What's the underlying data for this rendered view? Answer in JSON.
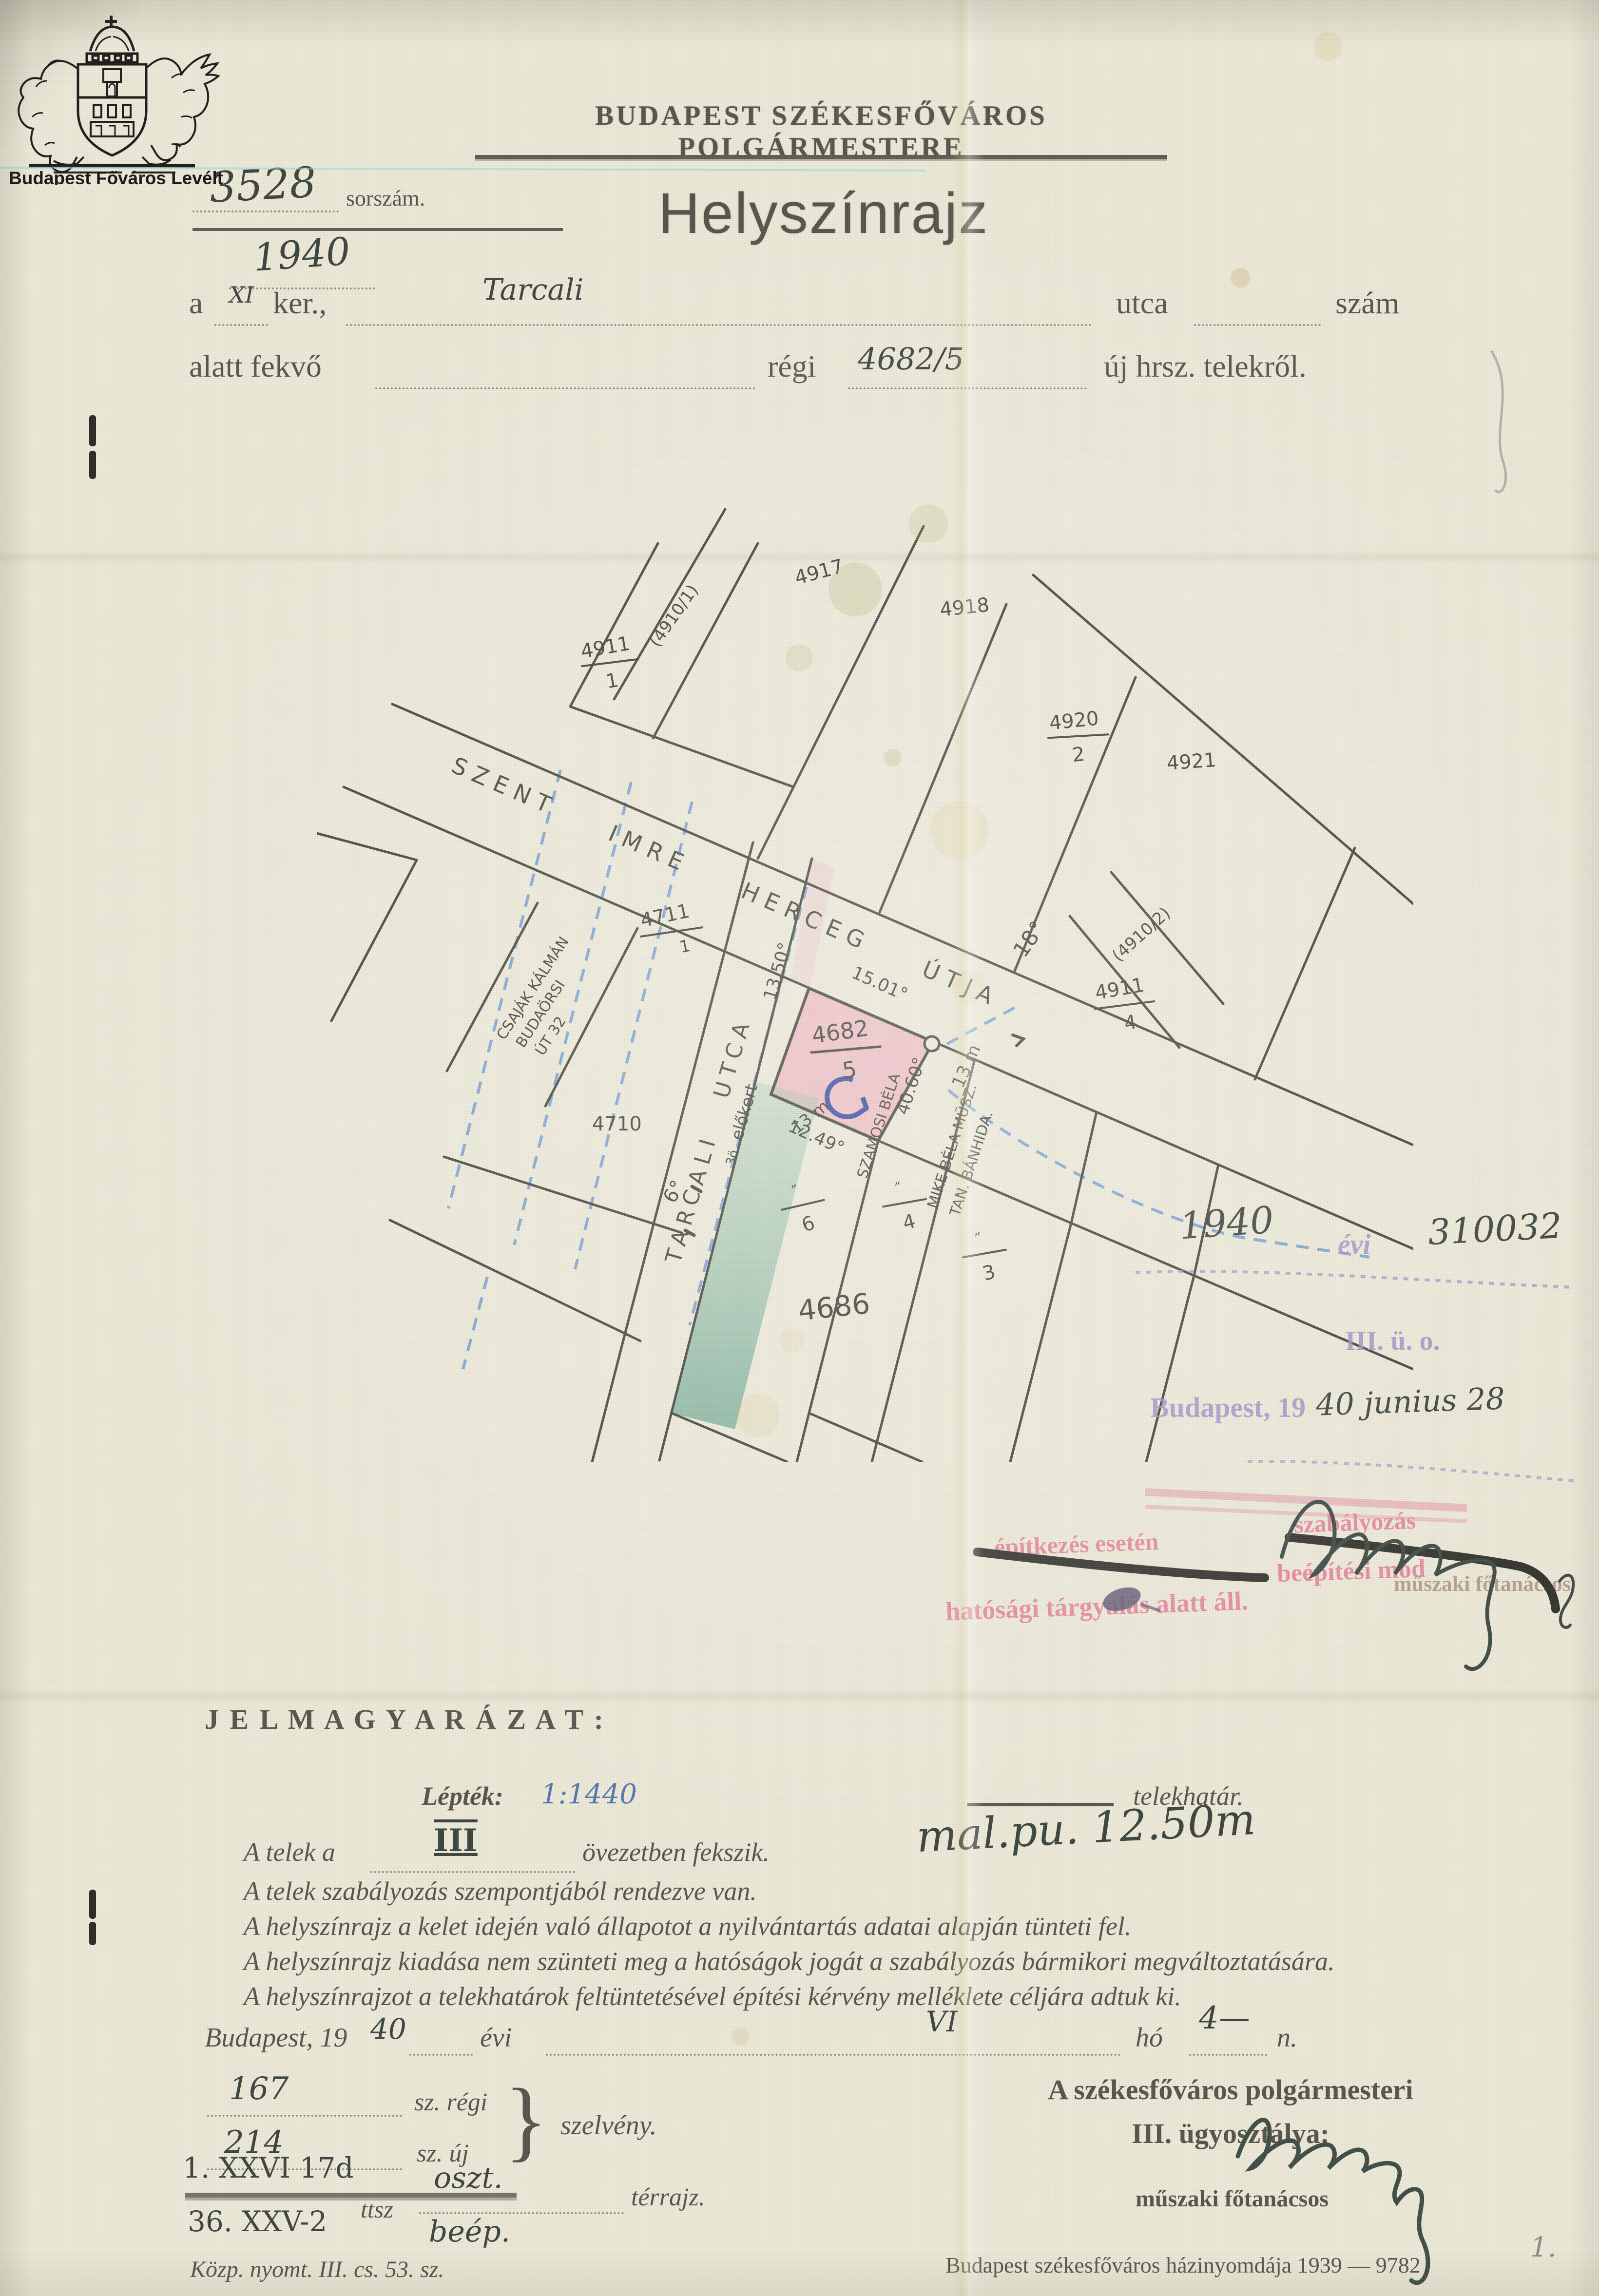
{
  "archive": {
    "name": "Budapest Főváros Levéltára"
  },
  "header": {
    "office": "BUDAPEST SZÉKESFŐVÁROS POLGÁRMESTERE",
    "serial_number": "3528",
    "serial_label": "sorszám.",
    "serial_year": "1940",
    "title": "Helyszínrajz"
  },
  "form": {
    "prefix": "a",
    "district": "XI",
    "ker": "ker.,",
    "street": "Tarcali",
    "utca": "utca",
    "szam": "szám",
    "line2": "alatt fekvő",
    "regi": "régi",
    "parcel": "4682/5",
    "line2_end": "új hrsz. telekről."
  },
  "map": {
    "street_main": "SZENT IMRE HERCEG ÚTJA",
    "street_cross": "TARCALI UTCA",
    "w18": "18°",
    "w6": "6°",
    "p4917": "4917",
    "p4910_1": "(4910/1)",
    "p4911a_n": "4911",
    "p4911a_d": "1",
    "p4918": "4918",
    "p4920_n": "4920",
    "p4920_d": "2",
    "p4921": "4921",
    "p4910_2": "(4910/2)",
    "p4911b_n": "4911",
    "p4911b_d": "4",
    "p4711_n": "4711",
    "p4711_d": "1",
    "p4710": "4710",
    "p4682_n": "4682",
    "p4682_d": "5",
    "f6_n": "″",
    "f6_d": "6",
    "f4_n": "″",
    "f4_d": "4",
    "f3_n": "″",
    "f3_d": "3",
    "p4686": "4686",
    "csajak1": "CSAJÁK KÁLMÁN",
    "csajak2": "BUDAÖRSI",
    "csajak3": "ÚT 32",
    "szamosi": "SZAMOSI BÉLA",
    "mike1": "MIKE BÉLA MŰSZ.",
    "mike2": "TAN. BÁNHIDA.",
    "m15": "15.01°",
    "m13": "13.50°",
    "m12": "12.49°",
    "m40": "40.60°",
    "elokert": "előkert",
    "m13a": "13 m",
    "m13b": "13 m",
    "s3o": "3ö"
  },
  "ann": {
    "year": "1940",
    "evi": "évi",
    "number": "310032",
    "dept": "III. ü. o.",
    "city": "Budapest, 19",
    "date": "40 junius 28",
    "counselor": "műszaki főtanácsos"
  },
  "stamp": {
    "struck1": "építkezés esetén",
    "struck2": "szabályozás",
    "line2": "beépítési mód",
    "line3": "hatósági tárgyalás alatt áll."
  },
  "legend": {
    "heading": "J E L M A G Y A R Á Z A T :",
    "scale_label": "Lépték:",
    "scale_value": "1:1440",
    "boundary": "telekhatár.",
    "zone_pre": "A telek a",
    "zone_val": "III",
    "zone_post": "övezetben fekszik.",
    "l2": "A telek szabályozás szempontjából rendezve van.",
    "l3": "A helyszínrajz a kelet idején való állapotot a nyilvántartás adatai alapján tünteti fel.",
    "l4": "A helyszínrajz kiadása nem szünteti meg a hatóságok jogát a szabályozás bármikori megváltoztatására.",
    "l5": "A helyszínrajzot a telekhatárok feltüntetésével építési kérvény melléklete céljára adtuk ki.",
    "note": "mal.pu. 12.50m"
  },
  "date": {
    "city": "Budapest, 19",
    "year": "40",
    "evi": "évi",
    "month": "VI",
    "ho": "hó",
    "day": "4—",
    "n": "n."
  },
  "sect": {
    "old_v": "167",
    "old_l": "sz. régi",
    "new_v": "214",
    "new_l": "sz. új",
    "brace": "}",
    "szelveny": "szelvény."
  },
  "appr": {
    "l1": "A székesfőváros polgármesteri",
    "l2": "III. ügyosztálya:",
    "counselor": "műszaki főtanácsos"
  },
  "codes": {
    "c1": "1. XXVI 17d",
    "c2": "36. XXV-2",
    "ttsz": "ttsz",
    "fill1": "oszt.",
    "terrajz": "térrajz.",
    "fill2": "beép."
  },
  "footer": {
    "left": "Közp. nyomt. III. cs. 53. sz.",
    "right": "Budapest székesfőváros házinyomdája 1939 — 9782",
    "page": "1."
  },
  "colors": {
    "paper": "#ece9d8",
    "ink_print": "#4f4d43",
    "ink_hand": "#313b36",
    "stamp_purple": "#9a8cc6",
    "stamp_pink": "#e46f91",
    "plot_pink": "#ef9fb6",
    "plot_green": "#66a78f",
    "pencil_blue": "#4a7fc1",
    "ink_green": "#2e9966"
  }
}
